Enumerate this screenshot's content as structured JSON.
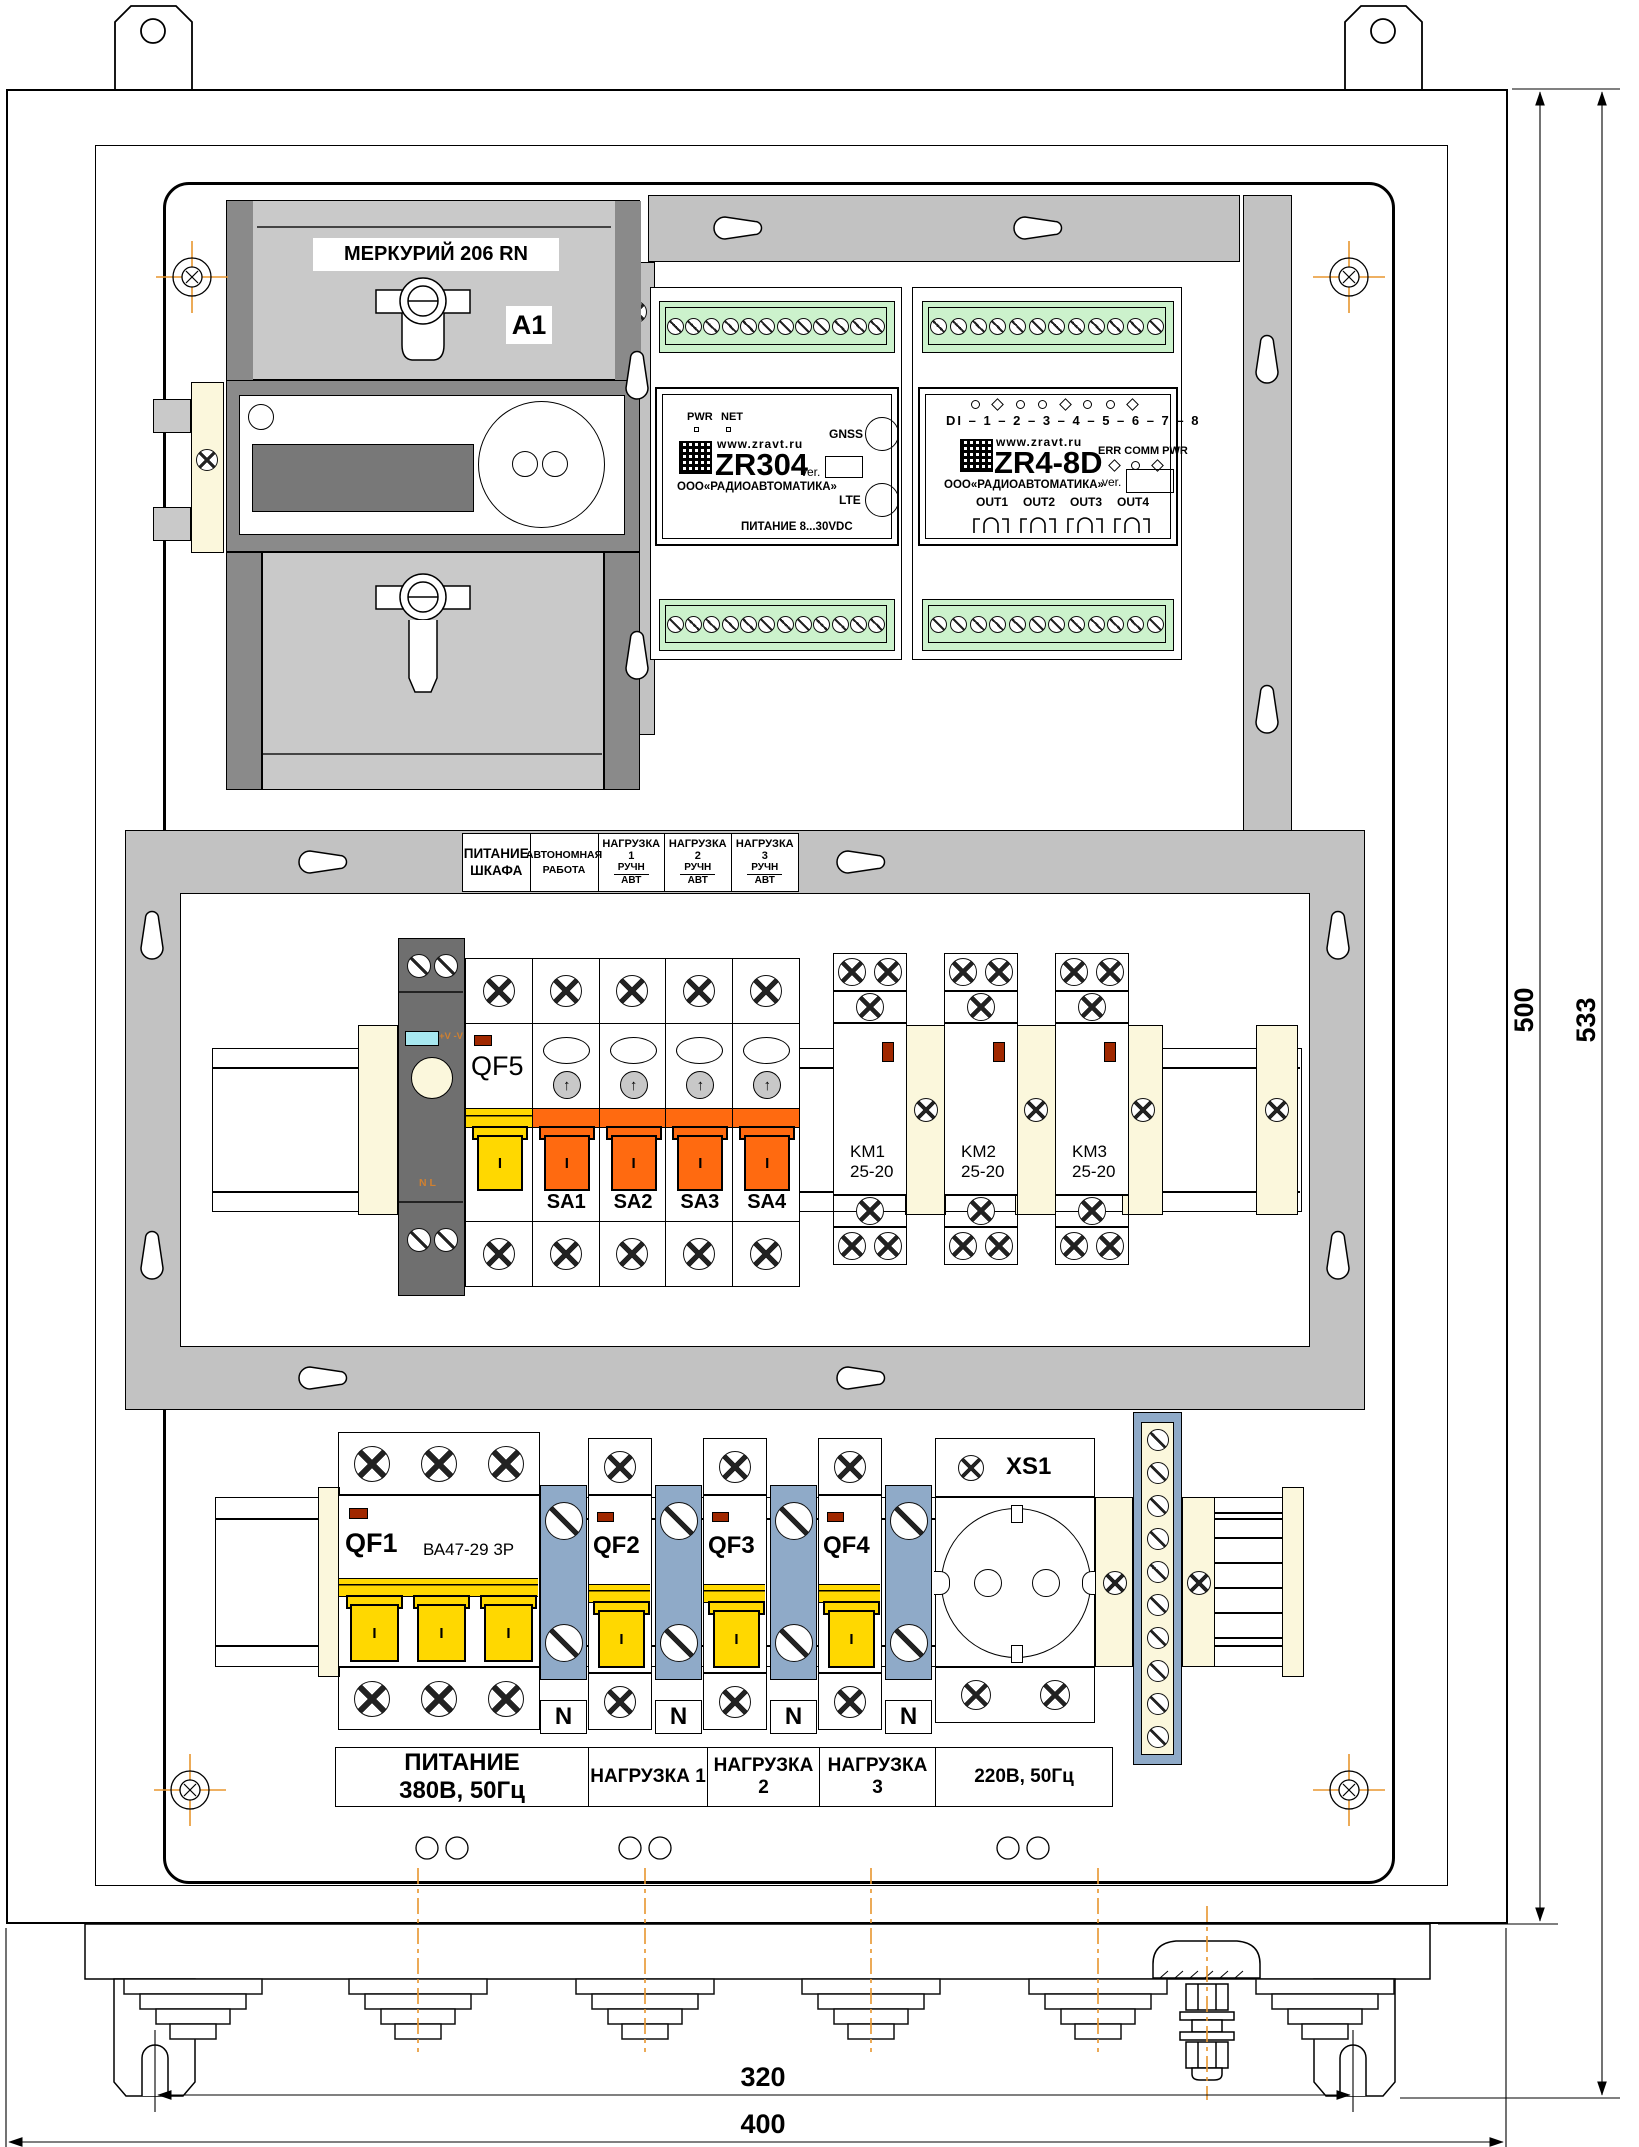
{
  "meter": {
    "model": "МЕРКУРИЙ 206 RN",
    "tag": "A1"
  },
  "zr304": {
    "led_pwr": "PWR",
    "led_net": "NET",
    "site": "www.zravt.ru",
    "model": "ZR304",
    "ver": "ver.",
    "company": "ООО«РАДИОАВТОМАТИКА»",
    "ant_gnss": "GNSS",
    "ant_lte": "LTE",
    "power": "ПИТАНИЕ 8...30VDC"
  },
  "zr48d": {
    "di": "DI – 1 – 2 – 3 – 4 – 5 – 6 – 7 – 8",
    "site": "www.zravt.ru",
    "model": "ZR4-8D",
    "leds": "ERR  COMM  PWR",
    "ver": "ver.",
    "company": "ООО«РАДИОАВТОМАТИКА»",
    "out1": "OUT1",
    "out2": "OUT2",
    "out3": "OUT3",
    "out4": "OUT4"
  },
  "strip": {
    "power_top": "ПИТАНИЕ",
    "power_bot": "ШКАФА",
    "auto_top": "АВТОНОМНАЯ",
    "auto_bot": "РАБОТА",
    "load1": "НАГРУЗКА 1",
    "load2": "НАГРУЗКА 2",
    "load3": "НАГРУЗКА 3",
    "manual": "РУЧН",
    "auto": "АВТ"
  },
  "psu": {
    "vv": "+V -V",
    "nl": "N  L"
  },
  "mid": {
    "qf5": "QF5",
    "sa1": "SA1",
    "sa2": "SA2",
    "sa3": "SA3",
    "sa4": "SA4",
    "km1": "KM1",
    "km2": "KM2",
    "km3": "KM3",
    "km_rating": "25-20"
  },
  "bottom": {
    "qf1": "QF1",
    "qf1_type": "ВА47-29 3Р",
    "qf2": "QF2",
    "qf3": "QF3",
    "qf4": "QF4",
    "n": "N",
    "xs1": "XS1",
    "supply_top": "ПИТАНИЕ",
    "supply_bot": "380В, 50Гц",
    "load1": "НАГРУЗКА 1",
    "load2": "НАГРУЗКА 2",
    "load3": "НАГРУЗКА 3",
    "socket": "220В, 50Гц"
  },
  "marks": {
    "on": "I"
  },
  "dims": {
    "h_inner": "500",
    "h_outer": "533",
    "w_inner": "320",
    "w_outer": "400"
  },
  "colors": {
    "toggle_yellow": "#ffd800",
    "toggle_orange": "#ff6a10",
    "terminal_green": "#ccf2cc",
    "neutral_blue": "#8faac8",
    "rail_cream": "#fbf7dc",
    "led_red": "#a02800",
    "led_cyan": "#a8e8f0",
    "centerline_orange": "#e8962e"
  }
}
